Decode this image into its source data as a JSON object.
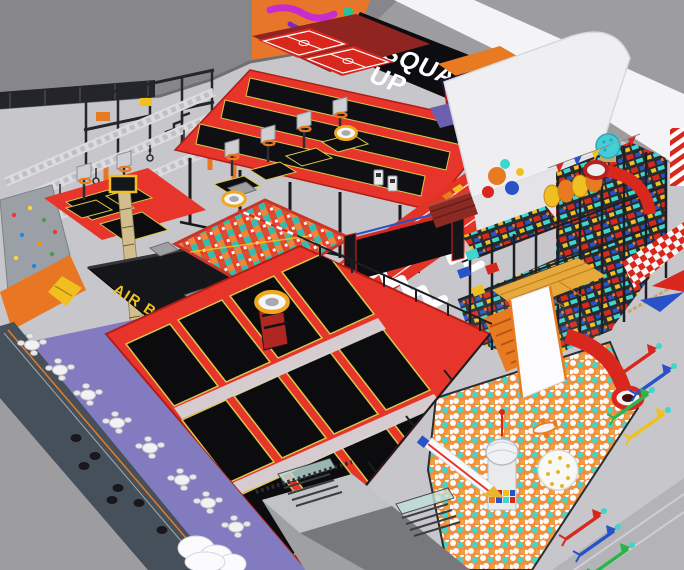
{
  "signs": {
    "squad_up_line1": "SQUAD",
    "squad_up_line2": "UP",
    "air_bag": "AIR BAG"
  },
  "colors": {
    "backdrop": "#9d9da0",
    "wall": "#87878b",
    "floor": "#c7c7cb",
    "roof_white": "#f4f4f6",
    "building_white": "#efeff2",
    "banner_black": "#0d0d11",
    "banner_text": "#ffffff",
    "graffiti_orange": "#e8762a",
    "frame_red": "#e8352b",
    "bed_black": "#0c0c0e",
    "bed_outline_yellow": "#d9c94a",
    "track_red": "#e23327",
    "carpet_purple": "#837bc0",
    "airbag_black": "#15161a",
    "sign_yellow": "#f2c21c",
    "cube_teal": "#3fd0c6",
    "ball_orange": "#ef8f3e",
    "playground_orange": "#e87a22",
    "slide_red": "#d8281e",
    "steel_black": "#22262c",
    "glass_teal": "#bfe0da"
  },
  "zones": [
    "back-wall",
    "graffiti-wall",
    "squad-up-banner",
    "ninja-course",
    "mezzanine-frame",
    "climbing-wall",
    "jump-measure-pole",
    "air-bag-pit",
    "slam-dunk-zone",
    "basketball-hoop-stations",
    "elevated-tumble-tracks",
    "dodgeball-courts",
    "foam-cube-pit",
    "running-track",
    "interactive-wall",
    "party-room-building",
    "soft-playground-structure",
    "ball-pit",
    "main-trampoline-court",
    "cafe-seating",
    "entrance-structure",
    "floor-darts",
    "walkway"
  ]
}
